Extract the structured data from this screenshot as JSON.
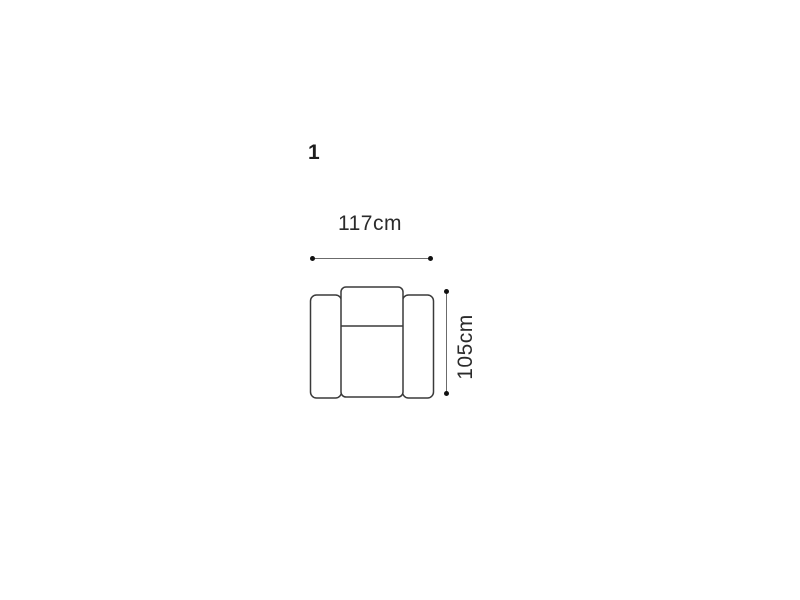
{
  "page": {
    "background_color": "#ffffff"
  },
  "diagram": {
    "item_number": "1",
    "subject": "armchair top view outline",
    "dimensions": {
      "width_label": "117cm",
      "height_label": "105cm"
    },
    "colors": {
      "outline": "#3a3a3a",
      "dimension_line": "#6b6b6b",
      "dimension_dot": "#111111",
      "text": "#2b2b2b",
      "item_number_text": "#1d1d1d"
    }
  }
}
